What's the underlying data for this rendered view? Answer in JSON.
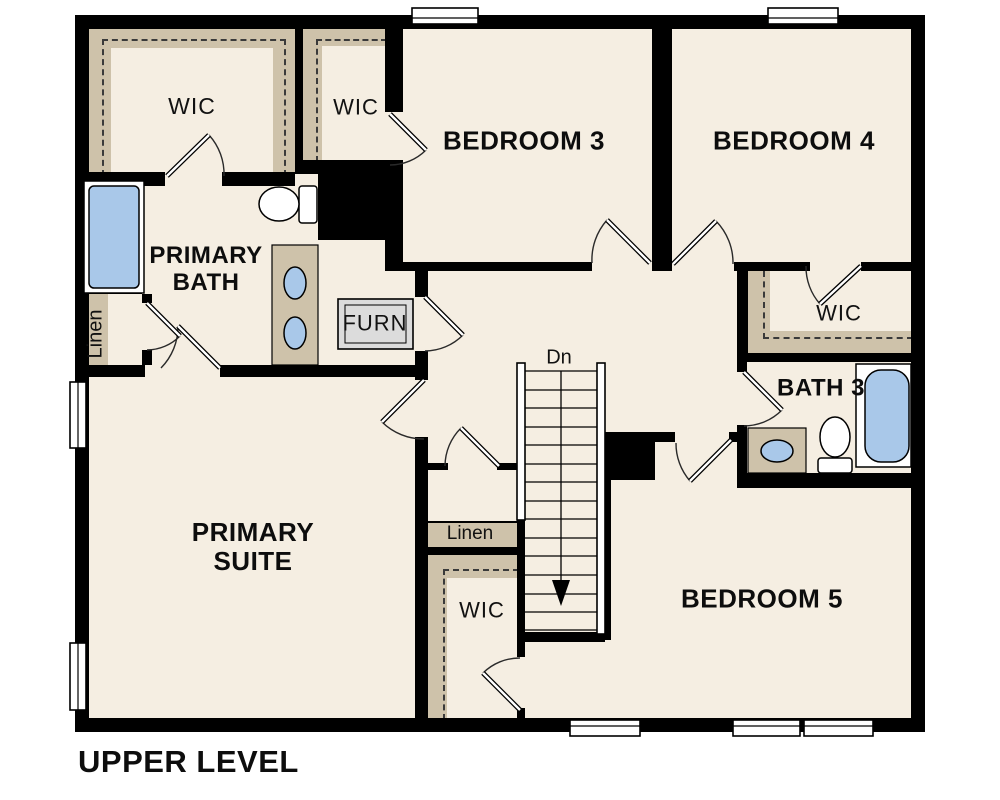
{
  "title": "UPPER LEVEL",
  "labels": {
    "wic_primary": "WIC",
    "wic_bedroom3": "WIC",
    "bedroom3": "BEDROOM 3",
    "bedroom4": "BEDROOM 4",
    "primary_bath": "PRIMARY BATH",
    "furnace": "FURN",
    "wic_bedroom4": "WIC",
    "bath3": "BATH 3",
    "stairs_down": "Dn",
    "linen_bath": "Linen",
    "linen_hall": "Linen",
    "wic_bedroom5": "WIC",
    "primary_suite": "PRIMARY SUITE",
    "bedroom5": "BEDROOM 5"
  },
  "colors": {
    "wall": "#000000",
    "floor": "#f5eee2",
    "shelf_tan": "#cec2aa",
    "fixture_blue": "#a9c8e9",
    "furnace_gray": "#dcdcdc",
    "background": "#ffffff"
  }
}
